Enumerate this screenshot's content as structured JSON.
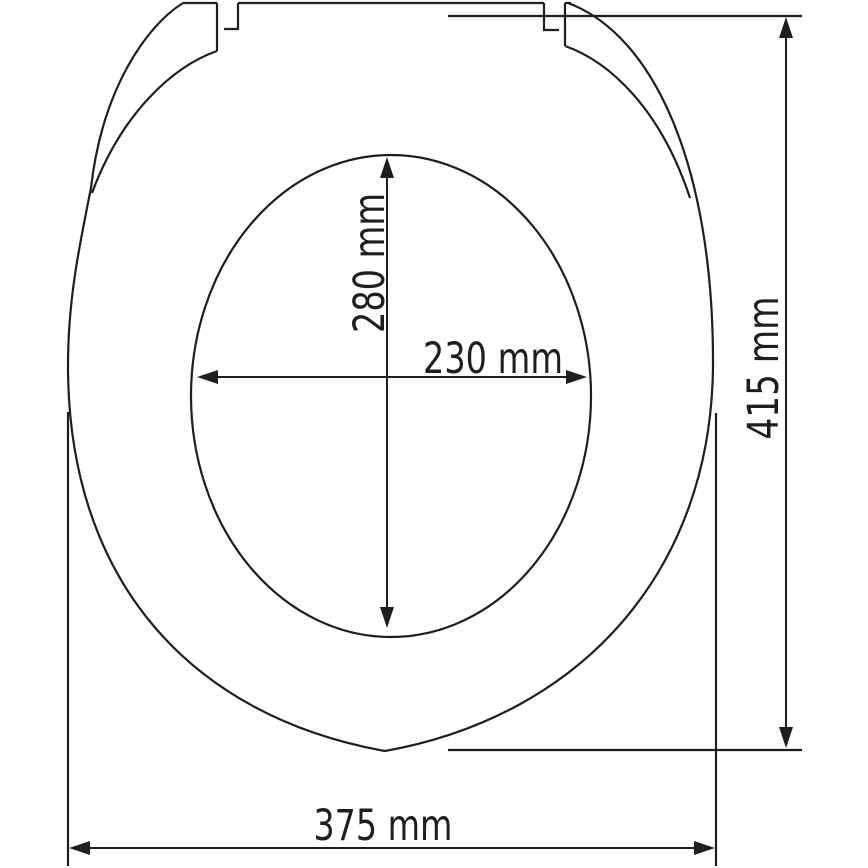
{
  "diagram": {
    "description": "Technical dimension drawing of an oval toilet seat, top view",
    "dimensions": {
      "inner_height": {
        "label": "280 mm",
        "value_mm": 280
      },
      "inner_width": {
        "label": "230 mm",
        "value_mm": 230
      },
      "outer_height": {
        "label": "415 mm",
        "value_mm": 415
      },
      "outer_width": {
        "label": "375 mm",
        "value_mm": 375
      }
    },
    "colors": {
      "line": "#1e1e1e",
      "background": "#ffffff"
    }
  }
}
